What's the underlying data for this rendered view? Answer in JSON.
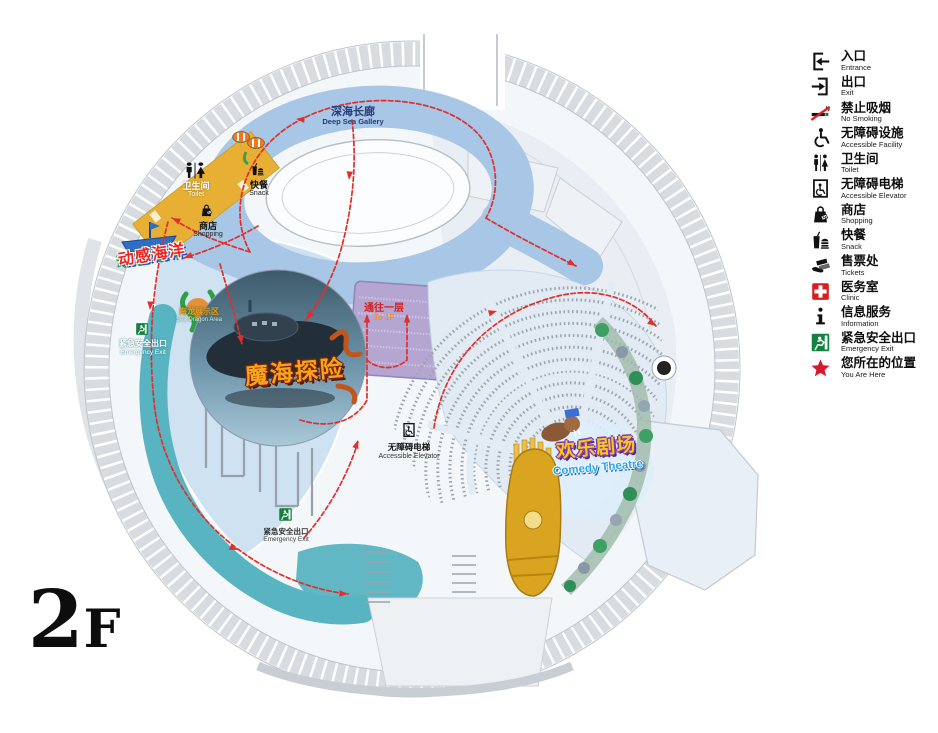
{
  "floor": {
    "label": "2F"
  },
  "colors": {
    "path-red": "#e02f2c",
    "teal": "#59b4c1",
    "yellow-strip": "#e7b034",
    "purple-room": "#b4a6d1",
    "loop-blue": "#a8c6e6",
    "legend-green": "#13813f",
    "clinic-red": "#d81e1e",
    "star-red": "#d8182a",
    "gold": "#d9a520"
  },
  "map": {
    "deep_sea_gallery": {
      "zh": "深海长廊",
      "en": "Deep Sea Gallery"
    },
    "toilet": {
      "zh": "卫生间",
      "en": "Toilet"
    },
    "snack": {
      "zh": "快餐",
      "en": "Snack"
    },
    "shopping": {
      "zh": "商店",
      "en": "Shopping"
    },
    "motion_ocean": {
      "zh": "动感海洋"
    },
    "sea_dragon": {
      "zh": "海龙展示区",
      "en": "Sea Dragon Area"
    },
    "emergency_exit_left": {
      "zh": "紧急安全出口",
      "en": "Emergency Exit"
    },
    "adventure": {
      "zh": "魔海探险"
    },
    "to_first_floor": {
      "zh": "通往一层",
      "en": "To 1F"
    },
    "accessible_elevator": {
      "zh": "无障碍电梯",
      "en": "Accessible Elevator"
    },
    "comedy_theatre": {
      "zh": "欢乐剧场",
      "en": "Comedy Theatre"
    },
    "emergency_exit_bottom": {
      "zh": "紧急安全出口",
      "en": "Emergency Exit"
    }
  },
  "legend": {
    "items": [
      {
        "icon": "entrance-icon",
        "zh": "入口",
        "en": "Entrance"
      },
      {
        "icon": "exit-icon",
        "zh": "出口",
        "en": "Exit"
      },
      {
        "icon": "no-smoking-icon",
        "zh": "禁止吸烟",
        "en": "No Smoking"
      },
      {
        "icon": "accessible-facility-icon",
        "zh": "无障碍设施",
        "en": "Accessible Facility"
      },
      {
        "icon": "toilet-icon",
        "zh": "卫生间",
        "en": "Toilet"
      },
      {
        "icon": "accessible-elevator-icon",
        "zh": "无障碍电梯",
        "en": "Accessible Elevator"
      },
      {
        "icon": "shopping-icon",
        "zh": "商店",
        "en": "Shopping"
      },
      {
        "icon": "snack-icon",
        "zh": "快餐",
        "en": "Snack"
      },
      {
        "icon": "tickets-icon",
        "zh": "售票处",
        "en": "Tickets"
      },
      {
        "icon": "clinic-icon",
        "zh": "医务室",
        "en": "Clinic"
      },
      {
        "icon": "information-icon",
        "zh": "信息服务",
        "en": "Information"
      },
      {
        "icon": "emergency-exit-icon",
        "zh": "紧急安全出口",
        "en": "Emergency Exit"
      },
      {
        "icon": "you-are-here-icon",
        "zh": "您所在的位置",
        "en": "You Are Here"
      }
    ]
  }
}
